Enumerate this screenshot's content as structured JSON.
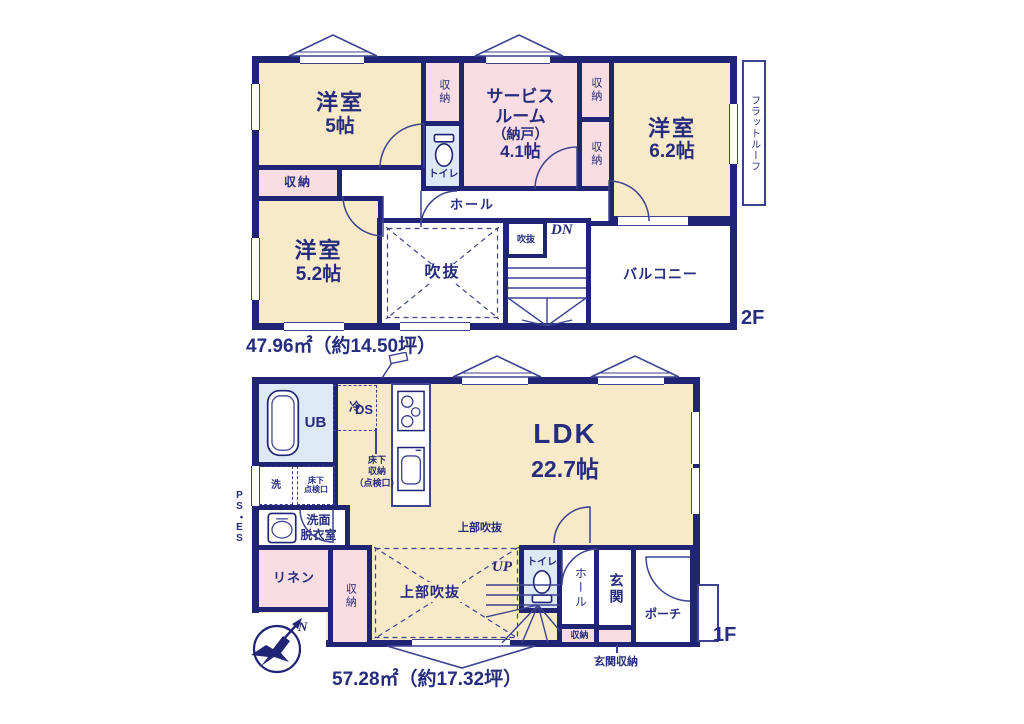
{
  "colors": {
    "wall": "#1f2475",
    "thin_line": "#3c4290",
    "text": "#262c7e",
    "room_cream": "#f8e9c8",
    "room_pink": "#fadde2",
    "room_blue": "#dde9f5"
  },
  "floor2": {
    "floor_label": "2F",
    "area": "47.96㎡（約14.50坪）",
    "yoshitsu5": {
      "name": "洋室",
      "size": "5帖"
    },
    "closet_top": "収納",
    "toilet": "トイレ",
    "service": {
      "l1": "サービス",
      "l2": "ルーム",
      "l3": "（納戸）",
      "l4": "4.1帖"
    },
    "closet_r1": "収納",
    "closet_r2": "収納",
    "yoshitsu62": {
      "name": "洋室",
      "size": "6.2帖"
    },
    "flat_roof": "フラットルーフ",
    "closet_left": "収納",
    "yoshitsu52": {
      "name": "洋室",
      "size": "5.2帖"
    },
    "hall": "ホール",
    "void_large": "吹抜",
    "void_small": "吹抜",
    "dn": "DN",
    "balcony": "バルコニー"
  },
  "floor1": {
    "floor_label": "1F",
    "area": "57.28㎡（約17.32坪）",
    "ub": "UB",
    "rei": "冷",
    "ds": "DS",
    "wash": "洗",
    "hatch": {
      "l1": "床下",
      "l2": "点検口"
    },
    "ps_es": "PS・ES",
    "senmen": {
      "l1": "洗面",
      "l2": "脱衣室"
    },
    "underfloor": {
      "l1": "床下",
      "l2": "収納",
      "l3": "（点検口）"
    },
    "ldk": {
      "name": "LDK",
      "size": "22.7帖"
    },
    "linen": "リネン",
    "closet": "収納",
    "void_top": "上部吹抜",
    "void_main": "上部吹抜",
    "up": "UP",
    "toilet": "トイレ",
    "hall": "ホール",
    "closet_small": "収納",
    "genkan": "玄関",
    "genkan_storage": "玄関収納",
    "porch": "ポーチ"
  },
  "compass": {
    "n": "N"
  }
}
